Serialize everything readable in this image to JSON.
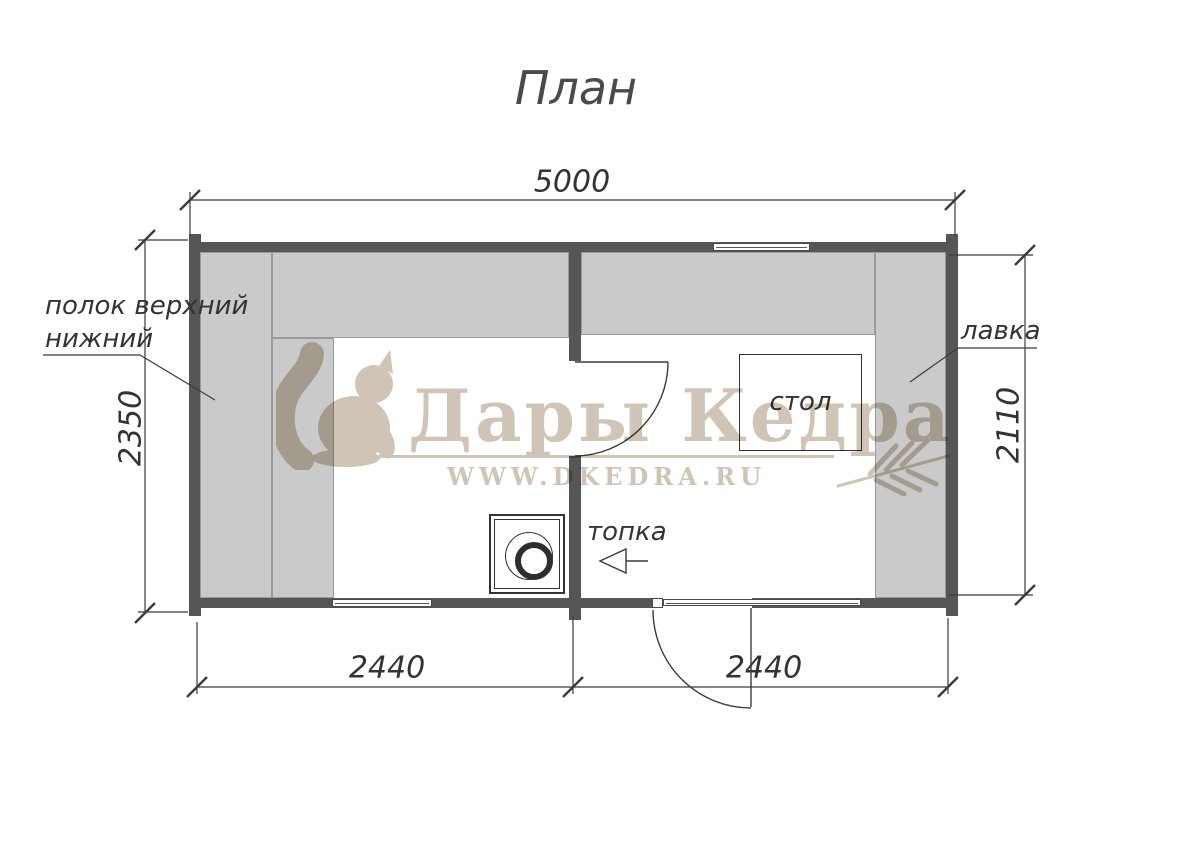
{
  "title": "План",
  "dimensions": {
    "overall_width": "5000",
    "left_height": "2350",
    "right_height": "2110",
    "bottom_left_width": "2440",
    "bottom_right_width": "2440"
  },
  "labels": {
    "shelf_line1": "полок верхний",
    "shelf_line2": "нижний",
    "bench": "лавка",
    "table": "стол",
    "firebox": "топка"
  },
  "rooms": {
    "left_room_features": [
      "полок верхний",
      "полок нижний",
      "печь"
    ],
    "right_room_features": [
      "лавка",
      "стол",
      "топка"
    ]
  },
  "watermark": {
    "brand": "Дары Кедра",
    "website": "WWW.DKEDRA.RU",
    "logo_icon": "squirrel-icon",
    "branch_icon": "fir-branch-icon"
  },
  "colors": {
    "wall": "#565656",
    "bench_fill": "#cacaca",
    "bench_border": "#9a9a9a",
    "line": "#3b3b3b",
    "watermark": "#cfc4b5",
    "background": "#ffffff"
  }
}
